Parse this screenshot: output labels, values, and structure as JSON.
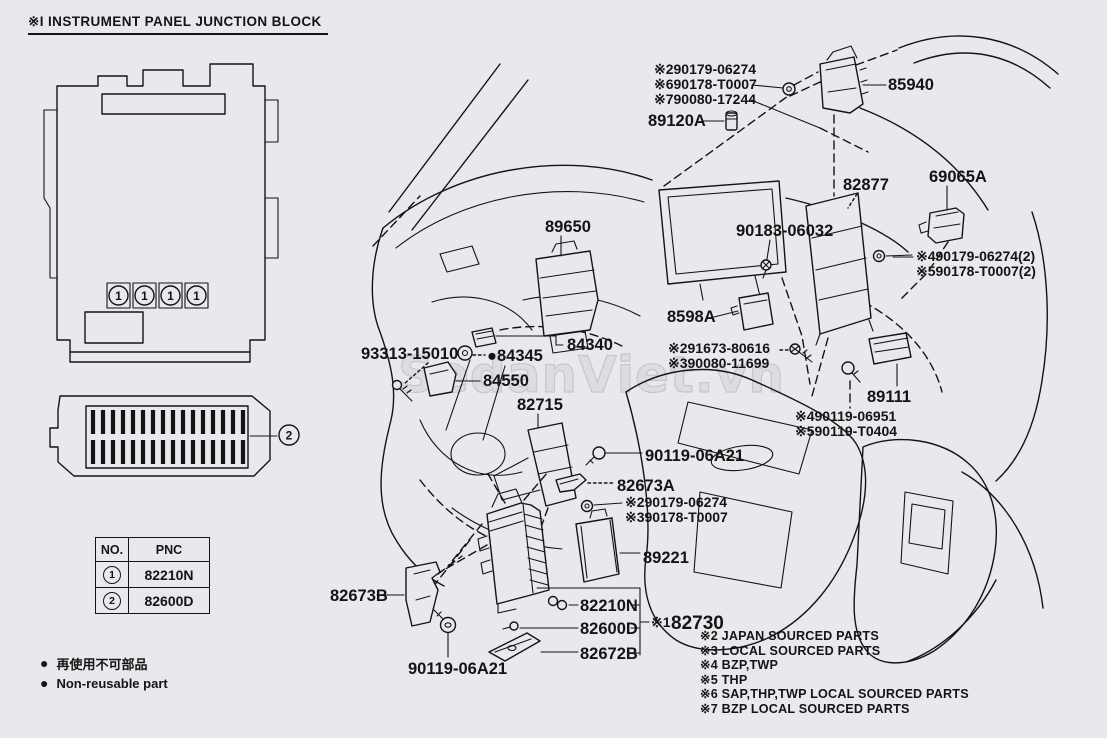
{
  "page": {
    "background": "#e9e9ed",
    "line_color": "#141414",
    "watermark_color": "#dcdce3"
  },
  "header": {
    "title": "※I INSTRUMENT PANEL JUNCTION BLOCK"
  },
  "watermark": {
    "text": "SedanViet.vn"
  },
  "callouts": {
    "one": "1",
    "two": "2"
  },
  "labels": {
    "top_group_1": "※290179-06274",
    "top_group_2": "※690178-T0007",
    "top_group_3": "※790080-17244",
    "p85940": "85940",
    "p89120A": "89120A",
    "p82877": "82877",
    "p69065A": "69065A",
    "p90183_06032": "90183-06032",
    "p89650": "89650",
    "right_group_1": "※490179-06274(2)",
    "right_group_2": "※590178-T0007(2)",
    "p8598A": "8598A",
    "p93313_15010": "93313-15010",
    "p84340": "84340",
    "p84345": "●84345",
    "p84550": "84550",
    "bolt_group_1": "※291673-80616",
    "bolt_group_2": "※390080-11699",
    "p82715": "82715",
    "p89111": "89111",
    "screw_group_1": "※490119-06951",
    "screw_group_2": "※590119-T0404",
    "p90119_06A21_upper": "90119-06A21",
    "p82673A": "82673A",
    "mid_group_1": "※290179-06274",
    "mid_group_2": "※390178-T0007",
    "p89221": "89221",
    "p82673B": "82673B",
    "p82210N": "82210N",
    "p82600D": "82600D",
    "p82730_prefix": "※1",
    "p82730": "82730",
    "p82672B": "82672B",
    "p90119_06A21_lower": "90119-06A21"
  },
  "table": {
    "headers": [
      "NO.",
      "PNC"
    ],
    "rows": [
      {
        "no": "1",
        "pnc": "82210N"
      },
      {
        "no": "2",
        "pnc": "82600D"
      }
    ]
  },
  "legend": {
    "bullet": "●",
    "items": [
      "再使用不可部品",
      "Non-reusable part"
    ]
  },
  "notes": [
    "※2 JAPAN SOURCED PARTS",
    "※3 LOCAL SOURCED PARTS",
    "※4 BZP,TWP",
    "※5 THP",
    "※6 SAP,THP,TWP LOCAL SOURCED PARTS",
    "※7 BZP LOCAL SOURCED PARTS"
  ]
}
